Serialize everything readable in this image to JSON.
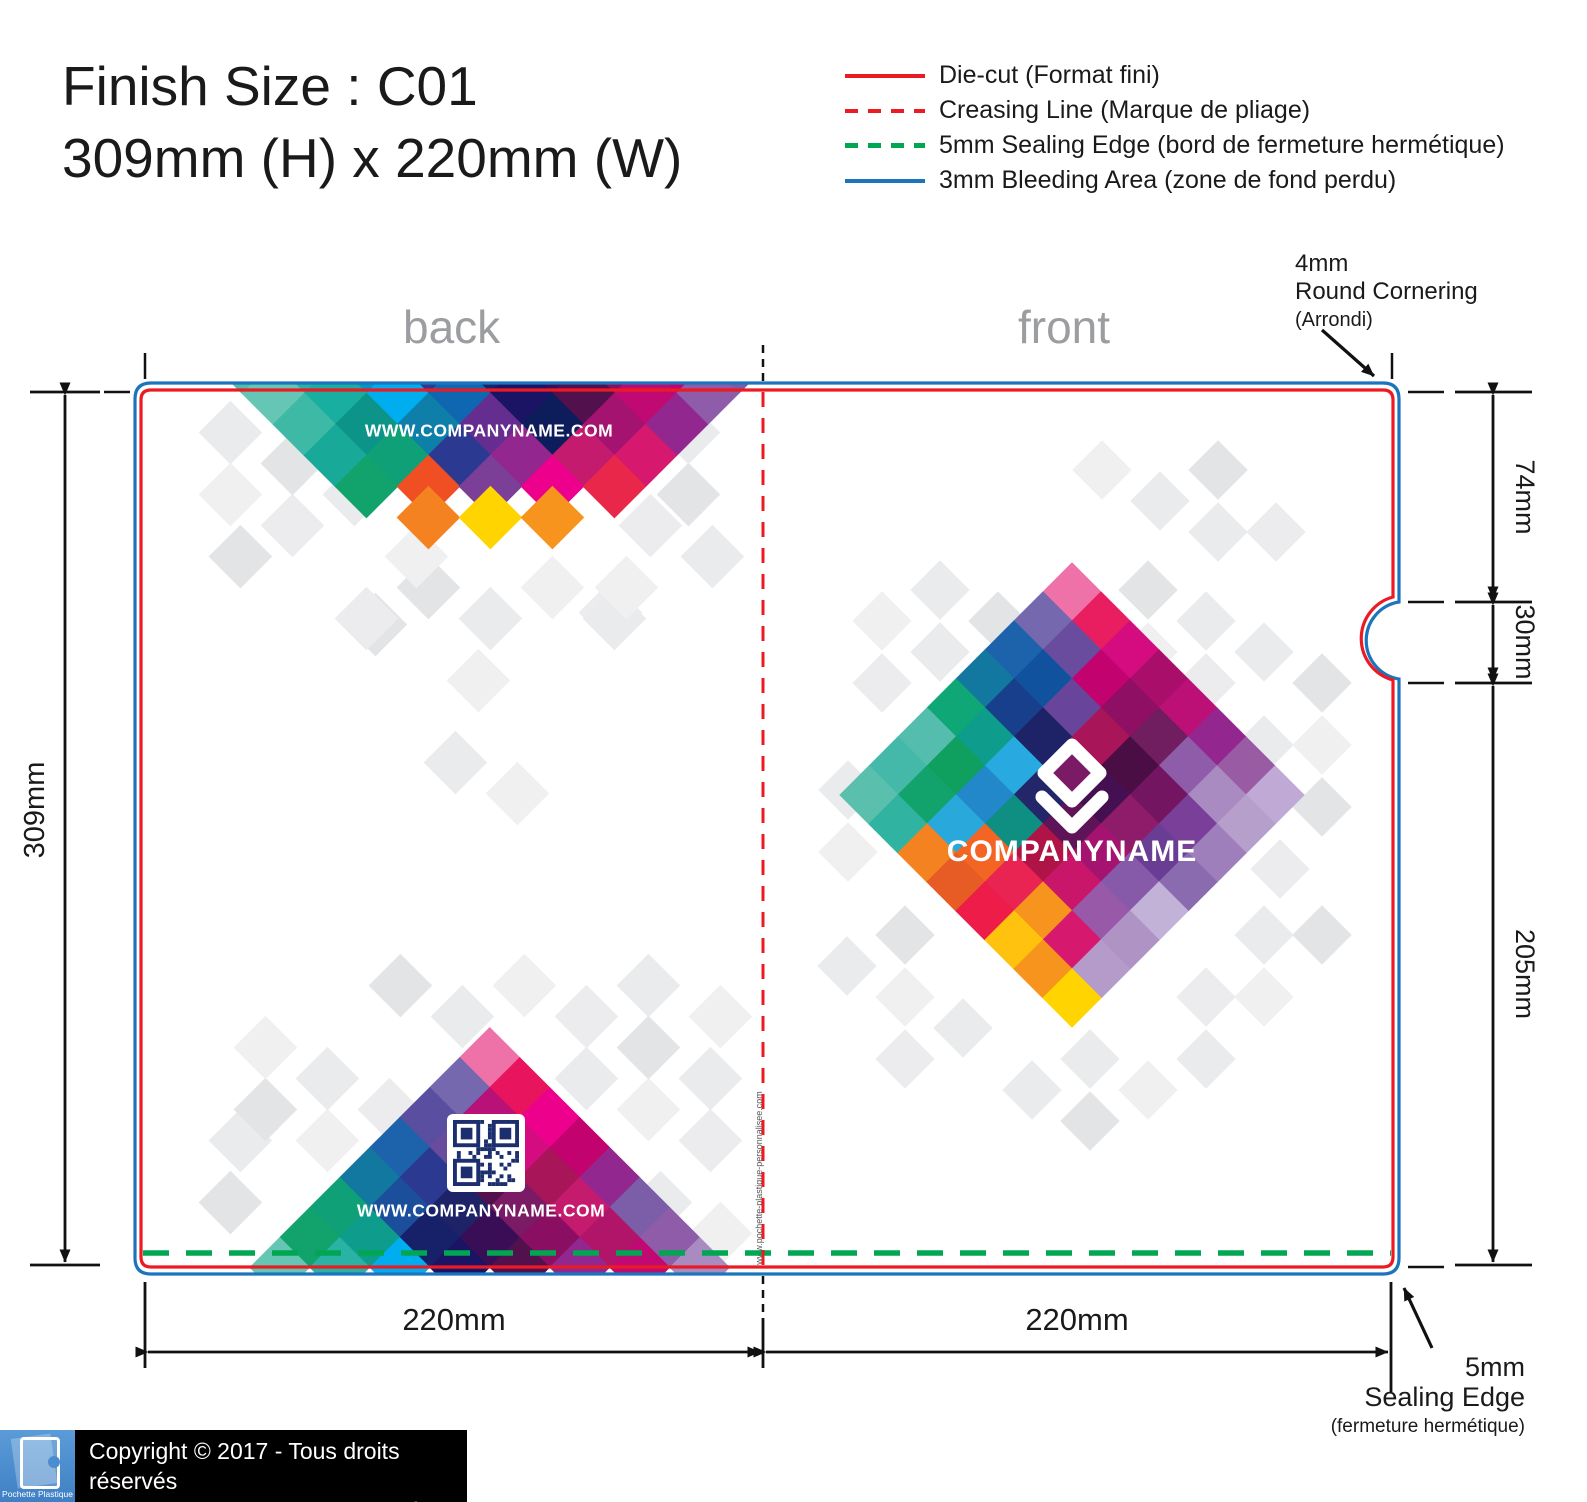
{
  "title": {
    "line1": "Finish Size : C01",
    "line2": "309mm (H) x 220mm (W)"
  },
  "legend": {
    "items": [
      {
        "label": "Die-cut (Format fini)",
        "color": "#ec1b23",
        "style": "solid"
      },
      {
        "label": "Creasing Line (Marque de pliage)",
        "color": "#ec1b23",
        "style": "dashed"
      },
      {
        "label": "5mm Sealing Edge (bord de fermeture hermétique)",
        "color": "#00a651",
        "style": "dashed"
      },
      {
        "label": "3mm Bleeding Area (zone de fond perdu)",
        "color": "#1c75bc",
        "style": "solid"
      }
    ]
  },
  "panels": {
    "back_label": "back",
    "front_label": "front"
  },
  "dimensions": {
    "height": "309mm",
    "top_section": "74mm",
    "notch": "30mm",
    "lower_section": "205mm",
    "back_width": "220mm",
    "front_width": "220mm"
  },
  "annotations": {
    "corner": {
      "line1": "4mm",
      "line2": "Round Cornering",
      "line3": "(Arrondi)"
    },
    "sealing": {
      "line1": "5mm",
      "line2": "Sealing Edge",
      "line3": "(fermeture hermétique)"
    }
  },
  "artwork": {
    "back_top_url": "WWW.COMPANYNAME.COM",
    "back_bottom_url": "WWW.COMPANYNAME.COM",
    "company_name": "COMPANYNAME",
    "crease_url": "www.pochette-plastique-personnalisee.com"
  },
  "footer": {
    "copyright_line1": "Copyright © 2017 - Tous droits réservés",
    "copyright_line2": "Pochette Plastique Personnalisée Couleur",
    "logo_text": "Pochette Plastique"
  },
  "line_colors": {
    "diecut": "#ec1b23",
    "crease": "#ec1b23",
    "sealing": "#00a651",
    "bleed": "#1c75bc",
    "dims": "#111111"
  },
  "gray_palette": [
    "#eaebec",
    "#e3e4e6",
    "#f0f0f1",
    "#ececee"
  ],
  "mosaics": {
    "back_top": {
      "cx": 490,
      "y0": 362,
      "step": 31,
      "d": 62,
      "bands": [
        [
          "#4FBDAC",
          "#2AB3A5",
          "#0096C7",
          "#2B3990",
          "#16216A",
          "#3A0E57",
          "#8A0F63",
          "#C2026F",
          "#7B5EA7"
        ],
        [
          "#66C6B5",
          "#19AFA0",
          "#00AEEF",
          "#0F67B1",
          "#1B1464",
          "#52104C",
          "#C00973",
          "#8E5CA8"
        ],
        [
          "#3DB9A6",
          "#0C9488",
          "#0D7FA8",
          "#662D91",
          "#0D1C5B",
          "#A4136F",
          "#92278F"
        ],
        [
          "#18A999",
          "#0FA077",
          "#2B3990",
          "#92278F",
          "#C51B6E",
          "#D6186E"
        ],
        [
          "#11A36B",
          "#F04E23",
          "#7C3F98",
          "#EC008C",
          "#E8274B"
        ],
        [
          "#F58220",
          "#FFD400",
          "#F7941D"
        ]
      ]
    },
    "back_bottom": {
      "cx": 490,
      "y0": 1058,
      "step": 30,
      "d": 60,
      "bands": [
        [
          "#EE72A8"
        ],
        [
          "#7568AE",
          "#E8145E"
        ],
        [
          "#5A4EA0",
          "#B81178",
          "#EC008C"
        ],
        [
          "#1C63AC",
          "#6A4C9F",
          "#D40C80",
          "#C2026F"
        ],
        [
          "#13789F",
          "#2B3990",
          "#52104C",
          "#A81558",
          "#92278F"
        ],
        [
          "#0FA077",
          "#1B4F9C",
          "#1D2366",
          "#7C1B65",
          "#C51B6E",
          "#7B5EA7"
        ],
        [
          "#11A36B",
          "#0E9C8C",
          "#16216A",
          "#3A0E57",
          "#8A0F63",
          "#B01569",
          "#8E5CA8"
        ],
        [
          "#66C6B5",
          "#2AB3A5",
          "#00AEEF",
          "#1B1464",
          "#52104C",
          "#92278F",
          "#C00973",
          "#A98BC1"
        ]
      ]
    },
    "front": {
      "cx": 1072,
      "y0": 592,
      "step": 29,
      "d": 58,
      "bands": [
        [
          "#EE72A8"
        ],
        [
          "#7568AE",
          "#E81E60"
        ],
        [
          "#1C63AC",
          "#6A4C9F",
          "#D40C80"
        ],
        [
          "#13789F",
          "#10529E",
          "#C2026F",
          "#A90F6A"
        ],
        [
          "#10A777",
          "#173F8B",
          "#68459B",
          "#8E0F63",
          "#BC1077"
        ],
        [
          "#54BDAD",
          "#0E9C8C",
          "#1D2366",
          "#A81558",
          "#701E5F",
          "#93268F"
        ],
        [
          "#45B9A9",
          "#0FA05F",
          "#28AAE1",
          "#7C1B65",
          "#4A0D44",
          "#8E5CA8",
          "#9A5BA5"
        ],
        [
          "#5BBFAE",
          "#11A36B",
          "#2288C9",
          "#232769",
          "#451051",
          "#731560",
          "#A98BC1",
          "#C0A9D4"
        ],
        [
          "#30B3A0",
          "#29A8DC",
          "#0E8F82",
          "#5E1457",
          "#8F1B6B",
          "#7A4099",
          "#B79FCC"
        ],
        [
          "#F58220",
          "#F26522",
          "#B01345",
          "#A4136F",
          "#6A3D94",
          "#9E7FBC"
        ],
        [
          "#E65C24",
          "#E92352",
          "#C9166B",
          "#865AA8",
          "#8A6BB0"
        ],
        [
          "#ED1C49",
          "#F7941D",
          "#9859A8",
          "#C3B2D8"
        ],
        [
          "#FFC20E",
          "#D6186E",
          "#AF93C5"
        ],
        [
          "#F7941D",
          "#B59BC9"
        ],
        [
          "#FFD400"
        ]
      ]
    }
  },
  "grays": {
    "back": {
      "d": 62,
      "cells": [
        [
          230,
          432,
          0
        ],
        [
          292,
          463,
          1
        ],
        [
          230,
          494,
          2
        ],
        [
          354,
          494,
          0
        ],
        [
          292,
          525,
          3
        ],
        [
          416,
          556,
          2
        ],
        [
          240,
          556,
          1
        ],
        [
          688,
          432,
          0
        ],
        [
          626,
          463,
          2
        ],
        [
          688,
          494,
          1
        ],
        [
          650,
          525,
          3
        ],
        [
          712,
          556,
          0
        ],
        [
          626,
          587,
          2
        ],
        [
          428,
          587,
          1
        ],
        [
          490,
          618,
          0
        ],
        [
          552,
          587,
          2
        ],
        [
          366,
          618,
          3
        ],
        [
          614,
          618,
          0
        ],
        [
          478,
          680,
          2
        ],
        [
          375,
          624,
          1
        ],
        [
          610,
          612,
          3
        ],
        [
          455,
          762,
          0
        ],
        [
          517,
          793,
          2
        ],
        [
          400,
          985,
          1
        ],
        [
          462,
          1016,
          0
        ],
        [
          524,
          985,
          2
        ],
        [
          586,
          1016,
          3
        ],
        [
          648,
          985,
          0
        ],
        [
          265,
          1047,
          2
        ],
        [
          327,
          1078,
          0
        ],
        [
          265,
          1109,
          1
        ],
        [
          389,
          1109,
          3
        ],
        [
          327,
          1140,
          2
        ],
        [
          240,
          1140,
          0
        ],
        [
          648,
          1047,
          1
        ],
        [
          710,
          1078,
          0
        ],
        [
          648,
          1109,
          2
        ],
        [
          710,
          1140,
          3
        ],
        [
          586,
          1078,
          0
        ],
        [
          720,
          1016,
          2
        ],
        [
          230,
          1202,
          1
        ],
        [
          660,
          1202,
          0
        ],
        [
          720,
          1233,
          2
        ]
      ]
    },
    "front": {
      "d": 58,
      "cells": [
        [
          940,
          590,
          0
        ],
        [
          998,
          621,
          1
        ],
        [
          882,
          621,
          2
        ],
        [
          940,
          652,
          0
        ],
        [
          882,
          683,
          3
        ],
        [
          1148,
          590,
          1
        ],
        [
          1206,
          621,
          0
        ],
        [
          1148,
          652,
          2
        ],
        [
          1264,
          652,
          0
        ],
        [
          1206,
          683,
          3
        ],
        [
          1322,
          683,
          1
        ],
        [
          1322,
          745,
          2
        ],
        [
          1264,
          745,
          0
        ],
        [
          1322,
          807,
          1
        ],
        [
          1280,
          869,
          3
        ],
        [
          848,
          790,
          0
        ],
        [
          848,
          852,
          2
        ],
        [
          1102,
          470,
          2
        ],
        [
          1160,
          501,
          0
        ],
        [
          1218,
          470,
          1
        ],
        [
          1276,
          532,
          3
        ],
        [
          1218,
          532,
          0
        ],
        [
          905,
          935,
          1
        ],
        [
          847,
          966,
          0
        ],
        [
          905,
          997,
          2
        ],
        [
          963,
          1028,
          0
        ],
        [
          905,
          1059,
          3
        ],
        [
          1032,
          1090,
          0
        ],
        [
          1090,
          1121,
          1
        ],
        [
          1148,
          1090,
          2
        ],
        [
          1090,
          1059,
          0
        ],
        [
          1206,
          997,
          3
        ],
        [
          1264,
          935,
          0
        ],
        [
          1322,
          935,
          1
        ],
        [
          1264,
          997,
          2
        ],
        [
          1206,
          1059,
          0
        ]
      ]
    }
  },
  "qr": {
    "navy": "#1B2F6E"
  }
}
